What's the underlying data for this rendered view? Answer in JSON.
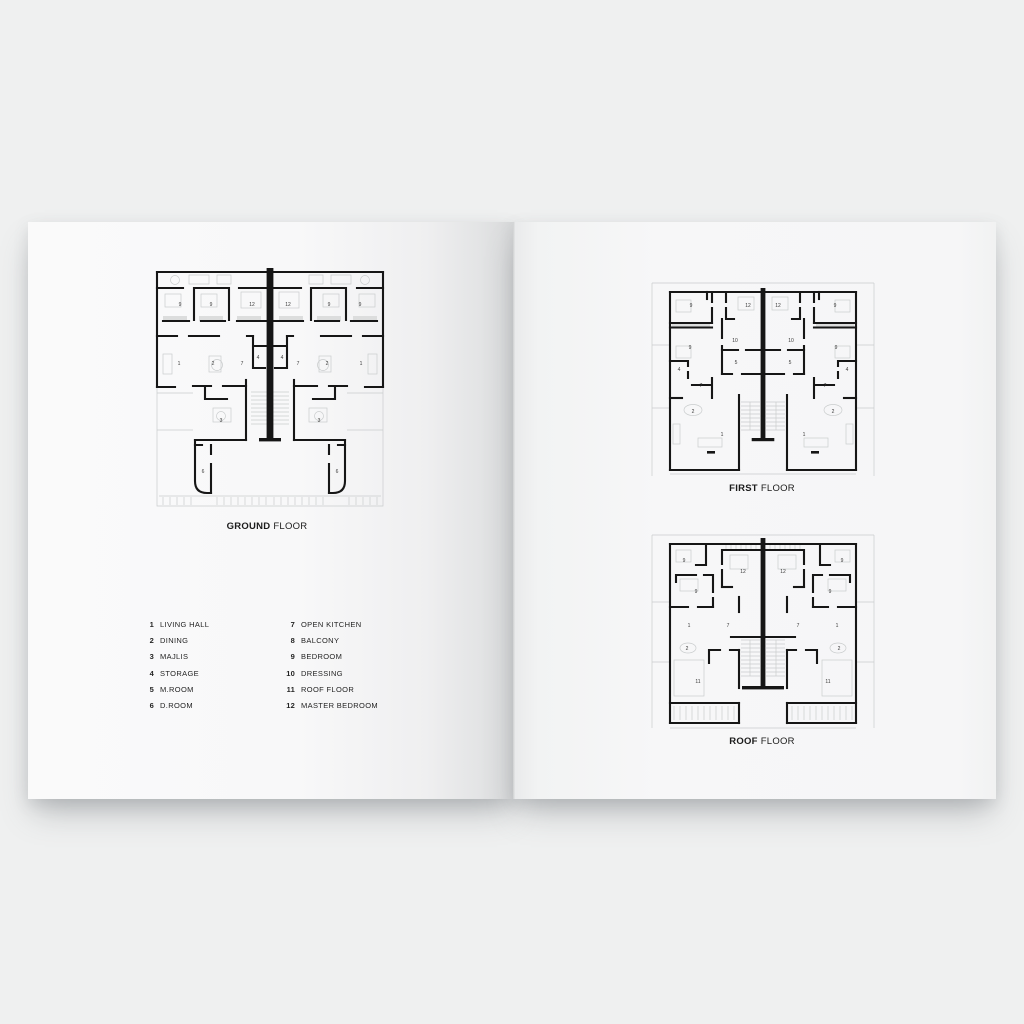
{
  "colors": {
    "background": "#eff0f0",
    "wall": "#161616",
    "faint": "#c9cccd",
    "closet": "#dcdddd",
    "label": "#3a3a3a",
    "title": "#1b1b1b",
    "text": "#242424"
  },
  "titles": {
    "ground": {
      "bold": "GROUND",
      "rest": "FLOOR"
    },
    "first": {
      "bold": "FIRST",
      "rest": "FLOOR"
    },
    "roof": {
      "bold": "ROOF",
      "rest": "FLOOR"
    }
  },
  "legend": {
    "columns": [
      {
        "items": [
          {
            "num": "1",
            "label": "LIVING HALL"
          },
          {
            "num": "2",
            "label": "DINING"
          },
          {
            "num": "3",
            "label": "MAJLIS"
          },
          {
            "num": "4",
            "label": "STORAGE"
          },
          {
            "num": "5",
            "label": "M.ROOM"
          },
          {
            "num": "6",
            "label": "D.ROOM"
          }
        ]
      },
      {
        "items": [
          {
            "num": "7",
            "label": "OPEN KITCHEN"
          },
          {
            "num": "8",
            "label": "BALCONY"
          },
          {
            "num": "9",
            "label": "BEDROOM"
          },
          {
            "num": "10",
            "label": "DRESSING"
          },
          {
            "num": "11",
            "label": "ROOF FLOOR"
          },
          {
            "num": "12",
            "label": "MASTER BEDROOM"
          }
        ]
      }
    ]
  },
  "plan_labels": {
    "ground": [
      {
        "t": "9",
        "x": 25,
        "y": 36
      },
      {
        "t": "9",
        "x": 56,
        "y": 36
      },
      {
        "t": "12",
        "x": 97,
        "y": 36
      },
      {
        "t": "12",
        "x": 133,
        "y": 36
      },
      {
        "t": "9",
        "x": 174,
        "y": 36
      },
      {
        "t": "9",
        "x": 205,
        "y": 36
      },
      {
        "t": "1",
        "x": 24,
        "y": 95
      },
      {
        "t": "2",
        "x": 58,
        "y": 95
      },
      {
        "t": "7",
        "x": 87,
        "y": 95
      },
      {
        "t": "4",
        "x": 103,
        "y": 89
      },
      {
        "t": "4",
        "x": 127,
        "y": 89
      },
      {
        "t": "7",
        "x": 143,
        "y": 95
      },
      {
        "t": "2",
        "x": 172,
        "y": 95
      },
      {
        "t": "1",
        "x": 206,
        "y": 95
      },
      {
        "t": "3",
        "x": 66,
        "y": 152
      },
      {
        "t": "3",
        "x": 164,
        "y": 152
      },
      {
        "t": "6",
        "x": 48,
        "y": 203
      },
      {
        "t": "6",
        "x": 182,
        "y": 203
      }
    ],
    "first": [
      {
        "t": "9",
        "x": 23,
        "y": 15
      },
      {
        "t": "12",
        "x": 80,
        "y": 15
      },
      {
        "t": "12",
        "x": 110,
        "y": 15
      },
      {
        "t": "9",
        "x": 167,
        "y": 15
      },
      {
        "t": "9",
        "x": 22,
        "y": 57
      },
      {
        "t": "10",
        "x": 67,
        "y": 50
      },
      {
        "t": "10",
        "x": 123,
        "y": 50
      },
      {
        "t": "9",
        "x": 168,
        "y": 57
      },
      {
        "t": "5",
        "x": 68,
        "y": 72
      },
      {
        "t": "5",
        "x": 122,
        "y": 72
      },
      {
        "t": "4",
        "x": 11,
        "y": 79
      },
      {
        "t": "4",
        "x": 179,
        "y": 79
      },
      {
        "t": "7",
        "x": 33,
        "y": 95
      },
      {
        "t": "7",
        "x": 157,
        "y": 95
      },
      {
        "t": "2",
        "x": 25,
        "y": 121
      },
      {
        "t": "2",
        "x": 165,
        "y": 121
      },
      {
        "t": "1",
        "x": 54,
        "y": 144
      },
      {
        "t": "1",
        "x": 136,
        "y": 144
      }
    ],
    "roof": [
      {
        "t": "9",
        "x": 16,
        "y": 18
      },
      {
        "t": "12",
        "x": 75,
        "y": 29
      },
      {
        "t": "12",
        "x": 115,
        "y": 29
      },
      {
        "t": "9",
        "x": 174,
        "y": 18
      },
      {
        "t": "9",
        "x": 28,
        "y": 49
      },
      {
        "t": "9",
        "x": 162,
        "y": 49
      },
      {
        "t": "1",
        "x": 21,
        "y": 83
      },
      {
        "t": "7",
        "x": 60,
        "y": 83
      },
      {
        "t": "7",
        "x": 130,
        "y": 83
      },
      {
        "t": "1",
        "x": 169,
        "y": 83
      },
      {
        "t": "2",
        "x": 19,
        "y": 106
      },
      {
        "t": "2",
        "x": 171,
        "y": 106
      },
      {
        "t": "11",
        "x": 30,
        "y": 139
      },
      {
        "t": "11",
        "x": 160,
        "y": 139
      }
    ]
  }
}
